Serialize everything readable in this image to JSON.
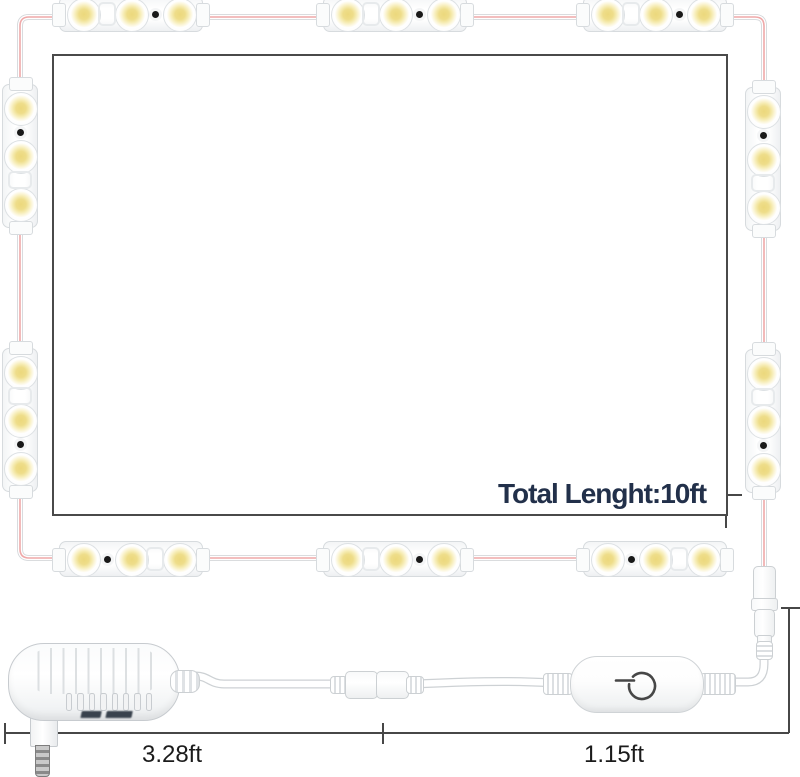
{
  "annotations": {
    "total_length_label": "Total Lenght:10ft",
    "segment_adapter_length": "3.28ft",
    "segment_dimmer_length": "1.15ft"
  },
  "colors": {
    "background": "#ffffff",
    "mirror_border": "#4a4a4a",
    "wire_red": "#efa9a9",
    "dimension_line": "#474747",
    "total_label": "#22304a",
    "measure_label": "#1b1b1b",
    "led_center_yellow": "#ecd87c",
    "module_white": "#ffffff",
    "power_icon": "#474747"
  },
  "led_strip": {
    "leds_per_module": 3,
    "module_count": 10,
    "geometry": {
      "length": 160,
      "cross": 44,
      "cross_center": 22,
      "led_offsets": [
        32,
        80,
        128
      ],
      "slot_offsets": {
        "1-2": 56,
        "2-3": 104
      },
      "led_diameter": 32
    },
    "modules": [
      {
        "id": "top-1",
        "orientation": "horizontal",
        "left": 51,
        "top": -8,
        "dot_slot": "2-3"
      },
      {
        "id": "top-2",
        "orientation": "horizontal",
        "left": 315,
        "top": -8,
        "dot_slot": "2-3"
      },
      {
        "id": "top-3",
        "orientation": "horizontal",
        "left": 575,
        "top": -8,
        "dot_slot": "2-3"
      },
      {
        "id": "left-1",
        "orientation": "vertical",
        "left": -2,
        "top": 76,
        "dot_slot": "1-2"
      },
      {
        "id": "left-2",
        "orientation": "vertical",
        "left": -2,
        "top": 340,
        "dot_slot": "2-3"
      },
      {
        "id": "right-1",
        "orientation": "vertical",
        "left": 741,
        "top": 79,
        "dot_slot": "1-2"
      },
      {
        "id": "right-2",
        "orientation": "vertical",
        "left": 741,
        "top": 341,
        "dot_slot": "2-3"
      },
      {
        "id": "bottom-1",
        "orientation": "horizontal",
        "left": 51,
        "top": 537,
        "dot_slot": "1-2"
      },
      {
        "id": "bottom-2",
        "orientation": "horizontal",
        "left": 315,
        "top": 537,
        "dot_slot": "2-3"
      },
      {
        "id": "bottom-3",
        "orientation": "horizontal",
        "left": 575,
        "top": 537,
        "dot_slot": "1-2"
      }
    ]
  },
  "adapter": {
    "vent_count": 8
  },
  "icons": {
    "dimmer_button": "power-icon"
  }
}
